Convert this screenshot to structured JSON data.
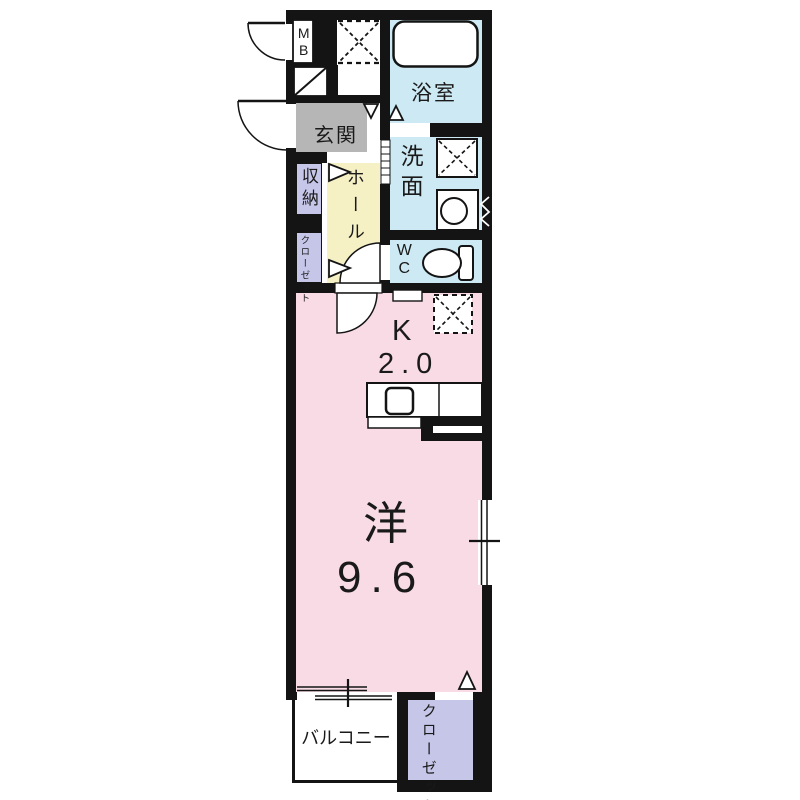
{
  "floorplan": {
    "rooms": {
      "meter_box": {
        "label": "MB"
      },
      "bath": {
        "label": "浴室"
      },
      "washroom": {
        "label": "洗面"
      },
      "wc": {
        "label": "WC"
      },
      "entrance": {
        "label": "玄関"
      },
      "hall": {
        "label": "ホール"
      },
      "storage": {
        "label": "収納"
      },
      "upper_closet": {
        "label": "クローゼット",
        "col1": "クロー",
        "col2": "ゼット"
      },
      "kitchen": {
        "label": "K",
        "area": "2.0"
      },
      "western_room": {
        "label": "洋",
        "area": "9.6"
      },
      "balcony": {
        "label": "バルコニー"
      },
      "lower_closet": {
        "label": "クローゼット",
        "col1": "クロー",
        "col2": "ゼット"
      }
    },
    "icons": {
      "bathtub": "rounded-rect",
      "toilet": "ellipse-with-tank",
      "washbasin": "square-with-circle",
      "washing_machine_space": "dashed-x-square",
      "refrigerator_space": "dashed-x-square",
      "service_space": "dashed-x-square",
      "door_swing": "quarter-arc",
      "sliding_window": "double-line",
      "opening_marker": "triangle"
    },
    "colors": {
      "wall": "#141414",
      "living_pink": "#f8dbe4",
      "wet_area_blue": "#cdeaf4",
      "hall_yellow": "#f6f0c5",
      "closet_purple": "#c6c6e9",
      "entrance_gray": "#b6b6b6"
    }
  }
}
